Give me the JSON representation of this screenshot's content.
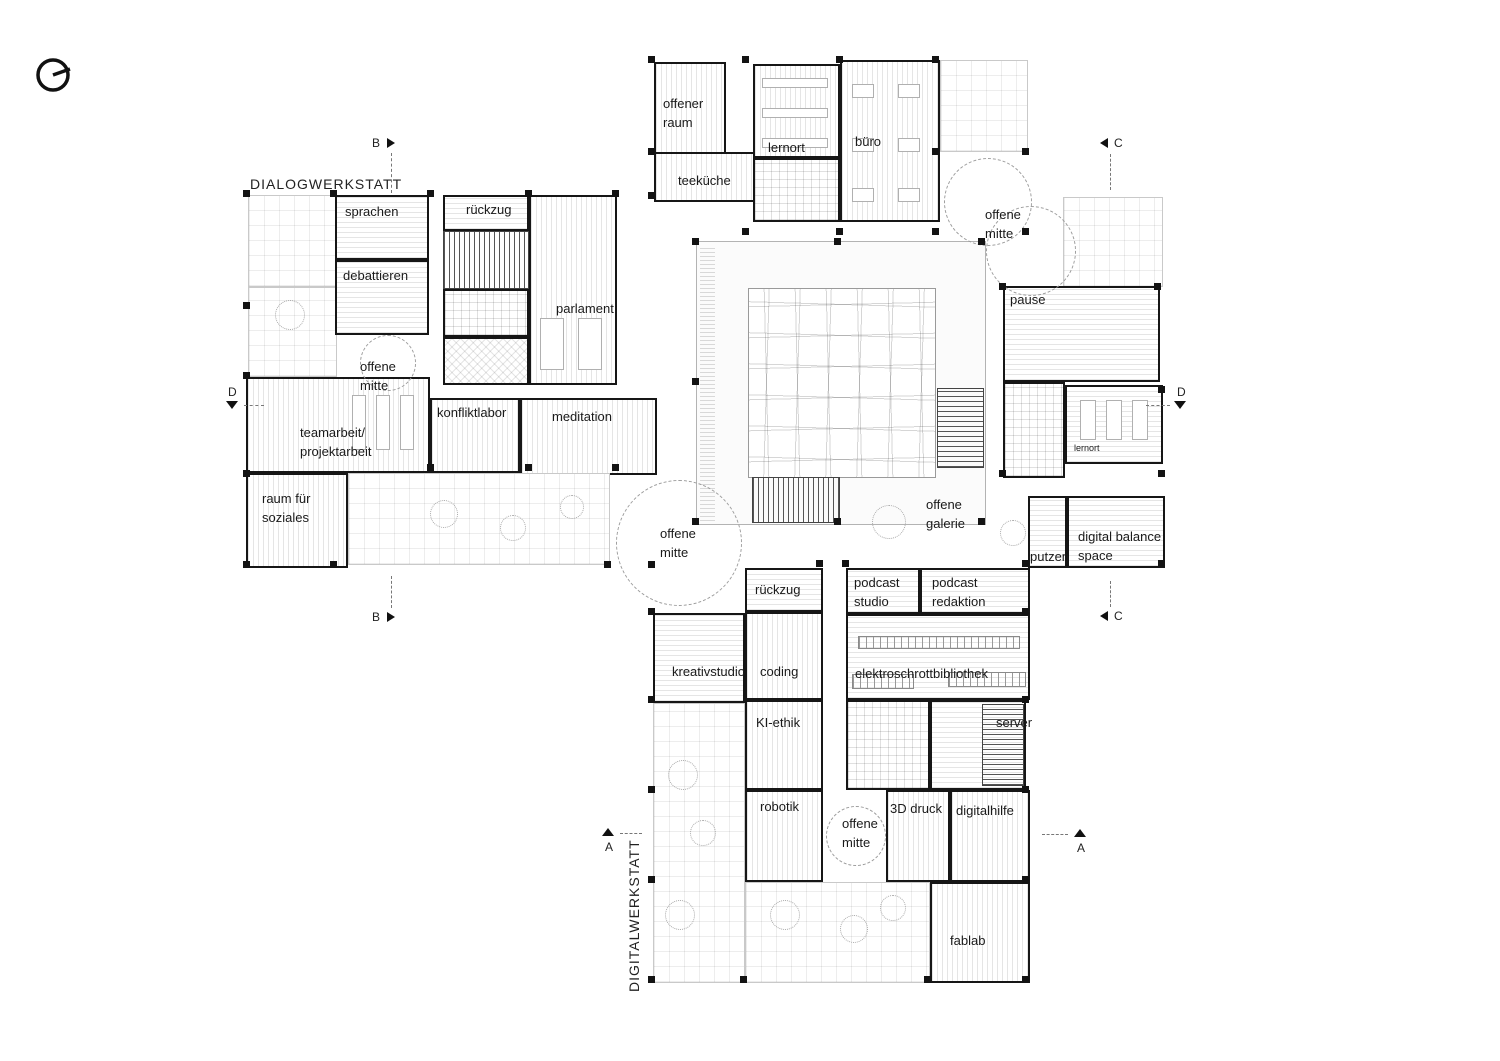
{
  "zones": {
    "dialogwerkstatt": "DIALOGWERKSTATT",
    "digitalwerkstatt": "DIGITALWERKSTATT"
  },
  "rooms": {
    "offener_raum": "offener\nraum",
    "teekueche": "teeküche",
    "lernort_top": "lernort",
    "buero": "büro",
    "offene_mitte_top": "offene\nmitte",
    "pause": "pause",
    "lernort_right": "lernort",
    "putzen": "putzen",
    "digital_balance": "digital balance\nspace",
    "sprachen": "sprachen",
    "rueckzug_top": "rückzug",
    "debattieren": "debattieren",
    "parlament": "parlament",
    "offene_mitte_left": "offene\nmitte",
    "teamarbeit": "teamarbeit/\nprojektarbeit",
    "konfliktlabor": "konfliktlabor",
    "meditation": "meditation",
    "raum_soziales": "raum für\nsoziales",
    "offene_mitte_center": "offene\nmitte",
    "offene_galerie": "offene\ngalerie",
    "rueckzug_bottom": "rückzug",
    "kreativstudio": "kreativstudio",
    "coding": "coding",
    "ki_ethik": "KI-ethik",
    "robotik": "robotik",
    "podcast_studio": "podcast\nstudio",
    "podcast_redaktion": "podcast\nredaktion",
    "elektro": "elektroschrottbibliothek",
    "server": "server",
    "offene_mitte_bottom": "offene\nmitte",
    "druck3d": "3D druck",
    "digitalhilfe": "digitalhilfe",
    "fablab": "fablab"
  },
  "section_markers": {
    "a_left": "A",
    "a_right": "A",
    "b_top": "B",
    "b_bottom": "B",
    "c_top": "C",
    "c_bottom": "C",
    "d_left": "D",
    "d_right": "D"
  },
  "colors": {
    "wall": "#161616",
    "hatch": "#d9d9d9",
    "terrace_grid": "#e3e3e3",
    "label": "#1a1a1a",
    "background": "#ffffff"
  }
}
